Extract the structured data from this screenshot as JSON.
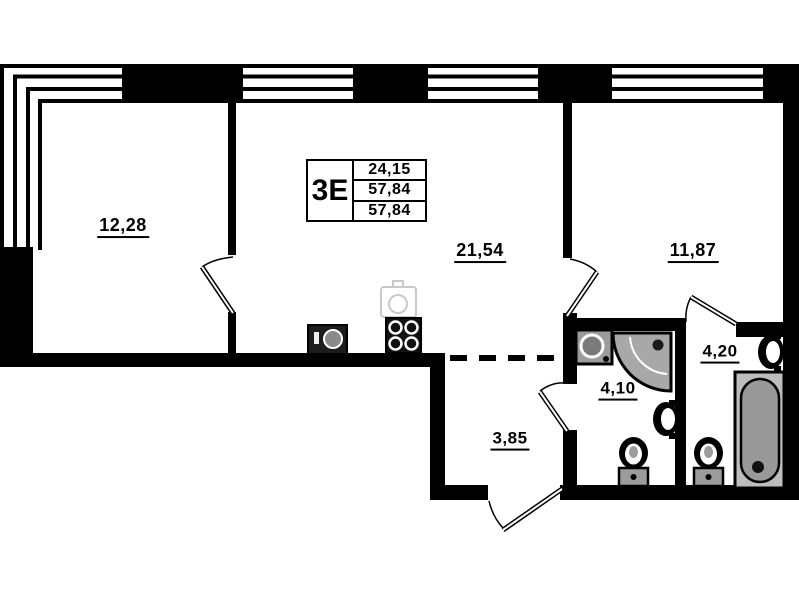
{
  "legend": {
    "type": "3Е",
    "rows": [
      "24,15",
      "57,84",
      "57,84"
    ]
  },
  "rooms": [
    {
      "name": "room-left",
      "area": "12,28"
    },
    {
      "name": "room-center",
      "area": "21,54"
    },
    {
      "name": "room-right",
      "area": "11,87"
    },
    {
      "name": "hallway",
      "area": "3,85"
    },
    {
      "name": "bathroom-1",
      "area": "4,10"
    },
    {
      "name": "bathroom-2",
      "area": "4,20"
    }
  ],
  "fixtures": [
    "washing-machine",
    "stove",
    "kitchen-sink",
    "shower",
    "wall-sink",
    "toilet",
    "bathtub"
  ],
  "colors": {
    "wall": "#000000",
    "fixture_gray": "#a0a0a0",
    "background": "#ffffff"
  }
}
